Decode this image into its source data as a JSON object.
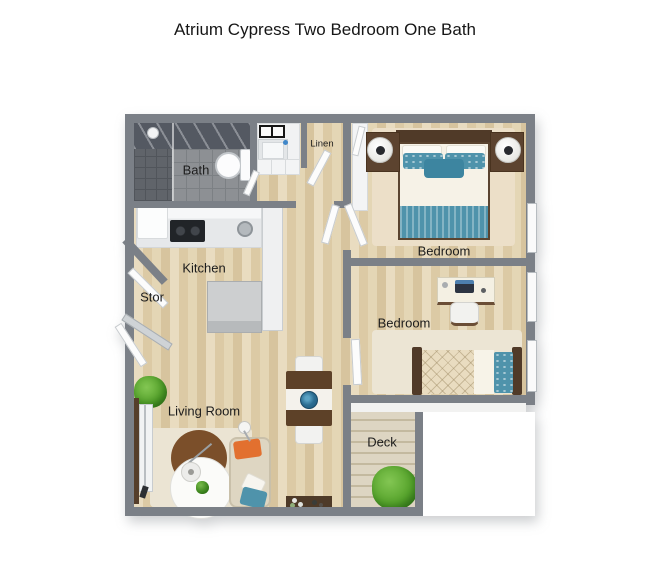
{
  "title": "Atrium Cypress Two Bedroom One Bath",
  "floorplan": {
    "labels": {
      "bath": "Bath",
      "linen": "Linen",
      "kitchen": "Kitchen",
      "storage": "Stor",
      "bedroom_top": "Bedroom",
      "bedroom_right": "Bedroom",
      "living_room": "Living Room",
      "deck": "Deck"
    },
    "colors": {
      "wall": "#7b8087",
      "wood-floor": "#e2d3b2",
      "bath-tile": "#8d9094",
      "shower-tile": "#60646a",
      "deck-wood": "#d8cfbb",
      "accent-teal": "#4f93ab",
      "accent-orange": "#e2702f",
      "plant-green": "#57a42c",
      "furniture-brown": "#553e2a",
      "rug-beige": "#ebe4d3",
      "label-text": "#1c1c1c"
    }
  }
}
